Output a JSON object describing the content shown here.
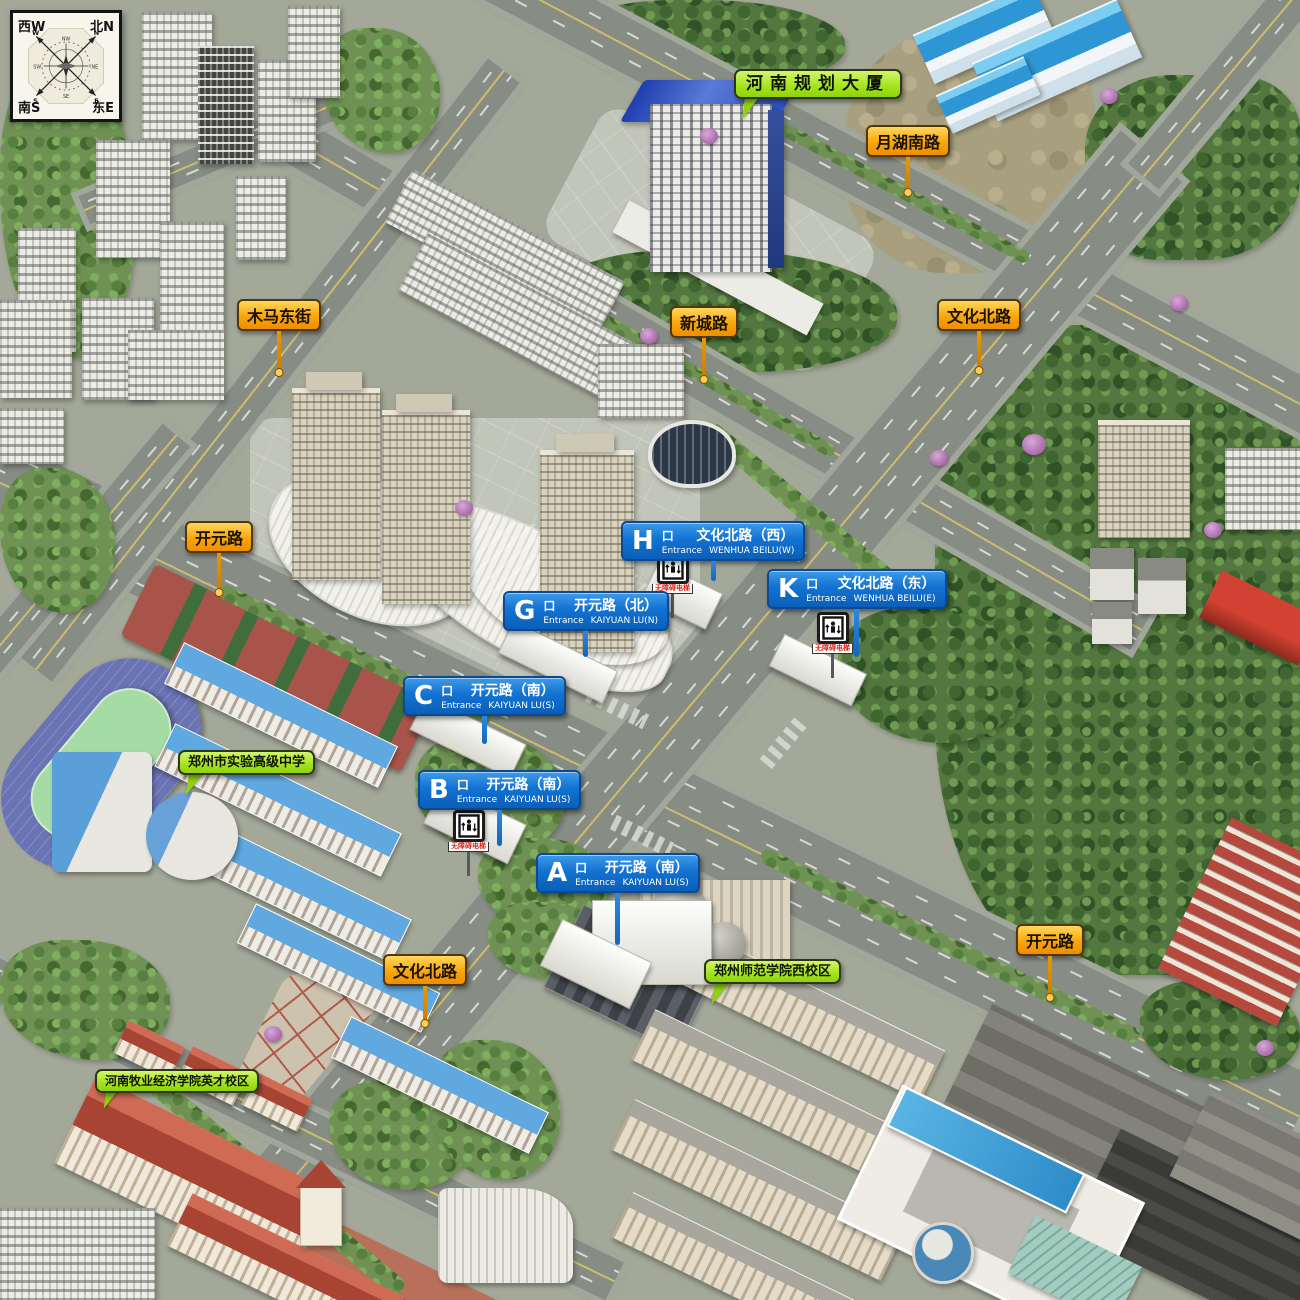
{
  "compass": {
    "corner_nw": "西W",
    "corner_ne": "北N",
    "corner_sw": "南S",
    "corner_se": "东E",
    "rose": {
      "n": "N",
      "w": "W",
      "s": "S",
      "e": "E",
      "nw": "NW",
      "ne": "NE",
      "sw": "SW",
      "se": "SE"
    }
  },
  "road_labels": [
    {
      "text": "月湖南路"
    },
    {
      "text": "木马东街"
    },
    {
      "text": "新城路"
    },
    {
      "text": "文化北路"
    },
    {
      "text": "开元路"
    },
    {
      "text": "文化北路"
    },
    {
      "text": "开元路"
    }
  ],
  "place_labels": [
    {
      "text": "河南规划大厦"
    },
    {
      "text": "郑州市实验高级中学"
    },
    {
      "text": "郑州师范学院西校区"
    },
    {
      "text": "河南牧业经济学院英才校区"
    }
  ],
  "entrances": [
    {
      "letter": "H",
      "gate": "口",
      "name_cn": "文化北路（西）",
      "entrance_label": "Entrance",
      "name_en": "WENHUA BEILU(W)"
    },
    {
      "letter": "K",
      "gate": "口",
      "name_cn": "文化北路（东）",
      "entrance_label": "Entrance",
      "name_en": "WENHUA BEILU(E)"
    },
    {
      "letter": "G",
      "gate": "口",
      "name_cn": "开元路（北）",
      "entrance_label": "Entrance",
      "name_en": "KAIYUAN LU(N)"
    },
    {
      "letter": "C",
      "gate": "口",
      "name_cn": "开元路（南）",
      "entrance_label": "Entrance",
      "name_en": "KAIYUAN LU(S)"
    },
    {
      "letter": "B",
      "gate": "口",
      "name_cn": "开元路（南）",
      "entrance_label": "Entrance",
      "name_en": "KAIYUAN LU(S)"
    },
    {
      "letter": "A",
      "gate": "口",
      "name_cn": "开元路（南）",
      "entrance_label": "Entrance",
      "name_en": "KAIYUAN LU(S)"
    }
  ],
  "elevator_sign": {
    "text_cn": "无障碍电梯"
  },
  "colors": {
    "road_label_bg": "#F8A60A",
    "place_label_bg": "#A2E41C",
    "entrance_sign_bg": "#1272D2",
    "elevator_text": "#D42A1E",
    "asphalt": "#878D85",
    "forest": "#5C7F46",
    "track": "#6A74B4",
    "field": "#A5DCA5"
  }
}
